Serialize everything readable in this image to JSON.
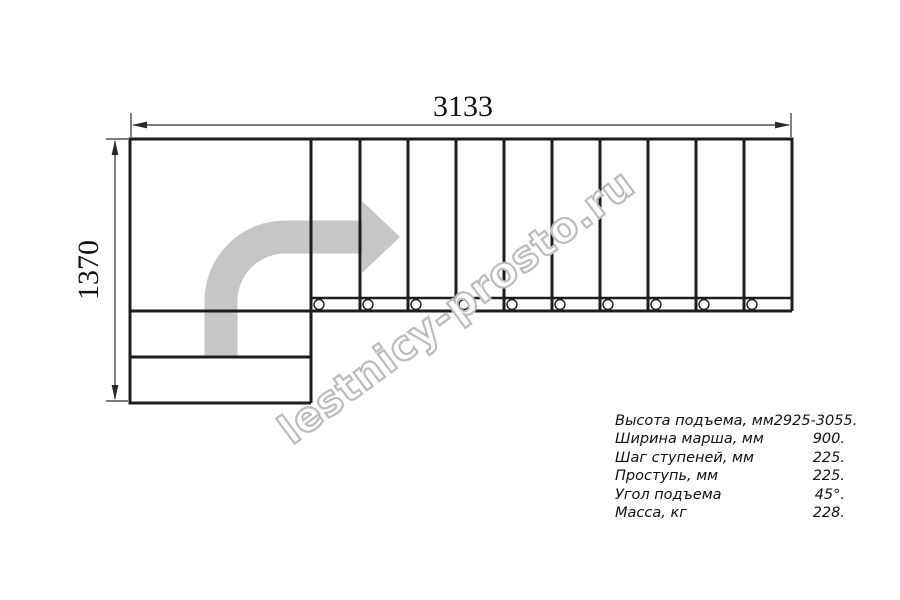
{
  "drawing": {
    "type": "staircase-plan-top-view",
    "dimensions": {
      "width_label": "3133",
      "height_label": "1370"
    },
    "steps_count": 10,
    "landing_steps_count": 2
  },
  "watermark": {
    "text": "lestnicy-prosto.ru"
  },
  "specs": {
    "rows": [
      {
        "label": "Высота подъема, мм",
        "value": "2925-3055."
      },
      {
        "label": "Ширина марша, мм",
        "value": "900."
      },
      {
        "label": "Шаг ступеней, мм",
        "value": "225."
      },
      {
        "label": "Проступь, мм",
        "value": "225."
      },
      {
        "label": "Угол подъема",
        "value": "45°."
      },
      {
        "label": "Масса, кг",
        "value": "228."
      }
    ]
  },
  "colors": {
    "background": "#ffffff",
    "line": "#1c1c1c",
    "arrow": "#c6c6c6",
    "watermark_outline": "#bcbcbc"
  }
}
